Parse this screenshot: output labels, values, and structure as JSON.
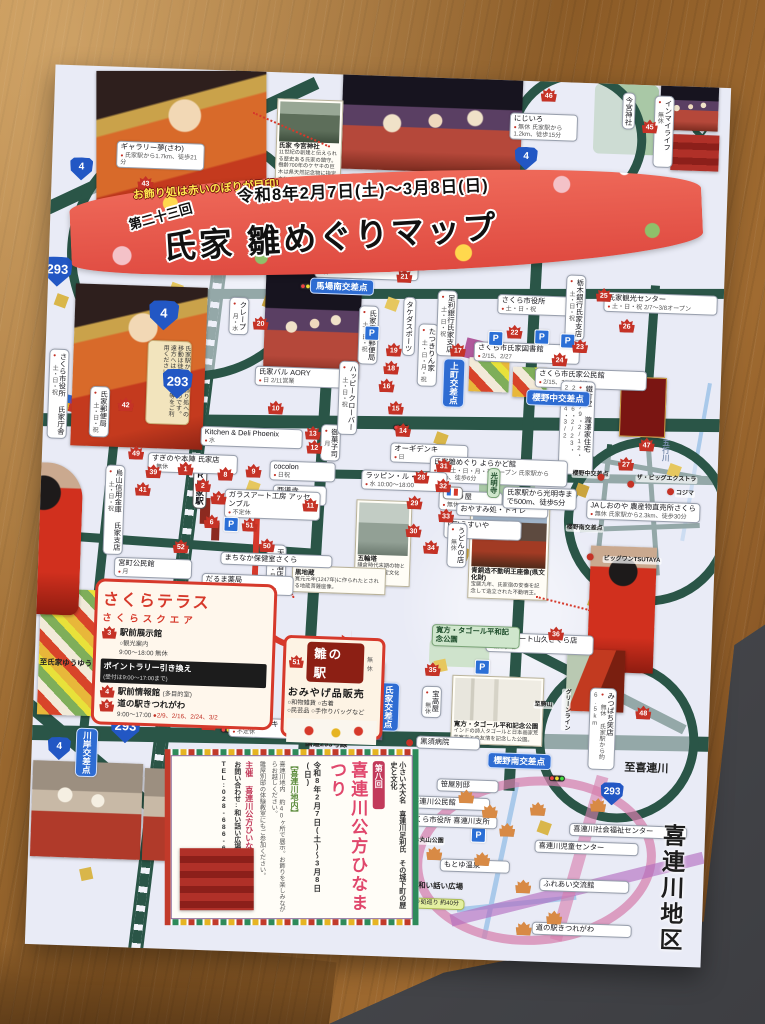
{
  "banner": {
    "tagline": "お飾り処は赤いのぼりが目印!",
    "edition": "第二十三回",
    "dates": "令和8年2月7日(土)〜3月8日(日)",
    "title": "氏家 雛めぐりマップ"
  },
  "sakura_terrace": {
    "heading": "さくらテラス",
    "sub": "さくらスクエア",
    "i1_num": "3",
    "i1_t": "駅前展示館",
    "i1_s1": "○観光案内",
    "i1_s2": "9:00〜18:00 無休",
    "rally": "ポイントラリー引き換え",
    "rally_s": "(受付は9:00〜17:00まで)",
    "i2_num": "4",
    "i3_num": "5",
    "i2_t": "駅前情報館",
    "i2_s": "(多目的室)",
    "i3_t": "道の駅きつれがわ",
    "hours": "9:00〜17:00",
    "days": "●2/9、2/16、2/24、3/2"
  },
  "hina_station": {
    "num": "51",
    "title": "雛の駅",
    "closed": "無休",
    "sub": "おみやげ品販売",
    "items1": "○和物雑貨 ○古着",
    "items2": "○民芸品 ○手作りバッグなど"
  },
  "kubo": {
    "edition": "第八回",
    "title": "喜連川公方ひなまつり",
    "dates": "令和8年2月7日(土)〜3月8日(日)",
    "area": "【喜連川地内】",
    "intro": "小さい大大名 喜連川足利氏 その城下町の歴史と文化",
    "body1": "喜連川地内 約40ヶ所で展示。お飾りを楽しみながらお越しください。",
    "body2": "雛屋別邸の体験教室にもご参加ください。",
    "org": "主催 喜連川公方ひいなの会",
    "contact": "お問い合わせ:和い話い広場",
    "tel": "TEL:028-686-6370"
  },
  "captions": {
    "imamiya_t": "氏家 今宮神社",
    "imamiya_b": "11世紀の創建と伝えられる歴史ある氏家の鎮守。樹齢700年のケヤキの巨木は県天然記念物に指定されている。",
    "fudo_t": "青銅造不動明王座像(県文化財)",
    "fudo_b": "宝暦九年、氏家宿の安泰を記念して造立された不動明王。",
    "gorin_t": "五輪塔",
    "gorin_b": "鎌倉時代末期の物とされる県指定文化財。",
    "kuro_t": "黒地蔵",
    "kuro_b": "寛元元年(1247年)に作られたとされる地蔵菩薩座像。",
    "tagore_t": "寛方・タゴール平和記念公園",
    "tagore_b": "インドの詩人タゴールと日本画家荒井寛方との友情を記念した公園。"
  },
  "misc": {
    "north": "N"
  },
  "overlays": [
    {
      "c": "shield sm",
      "st": "left:18px;top:92px",
      "t": "4"
    },
    {
      "c": "shield",
      "st": "left:-6px;top:192px",
      "t": "293"
    },
    {
      "c": "shield",
      "st": "left:102px;top:232px",
      "t": "4"
    },
    {
      "c": "shield",
      "st": "left:118px;top:300px",
      "t": "293"
    },
    {
      "c": "shield",
      "st": "left:78px;top:646px",
      "t": "293"
    },
    {
      "c": "shield sm",
      "st": "left:16px;top:672px",
      "t": "4"
    },
    {
      "c": "shield sm",
      "st": "left:462px;top:66px",
      "t": "4"
    },
    {
      "c": "shield sm",
      "st": "left:570px;top:698px",
      "t": "293"
    },
    {
      "c": "isec",
      "st": "left:262px;top:204px",
      "t": "馬場南交差点"
    },
    {
      "c": "isec v",
      "st": "left:398px;top:280px",
      "t": "上町交差点"
    },
    {
      "c": "isec",
      "st": "left:482px;top:308px",
      "t": "櫻野中交差点"
    },
    {
      "c": "isec",
      "st": "left:456px;top:672px",
      "t": "櫻野南交差点"
    },
    {
      "c": "isec v",
      "st": "left:44px;top:662px",
      "t": "川岸交差点"
    },
    {
      "c": "isec v",
      "st": "left:344px;top:606px",
      "t": "氏家交差点"
    },
    {
      "c": "co v jr",
      "st": "left:152px;top:386px",
      "t": "JR氏家駅"
    },
    {
      "c": "co",
      "st": "left:64px;top:74px;width:80px",
      "t": "ギャラリー夢(さわ)",
      "s2": "氏家駅から1.7km、徒歩21分"
    },
    {
      "c": "mk",
      "st": "left:86px;top:108px",
      "t": "43"
    },
    {
      "c": "mk",
      "st": "left:118px;top:124px",
      "t": "44"
    },
    {
      "c": "v",
      "st": "left:4px;top:284px",
      "t": "さくら市役所 氏家庁舎",
      "s2": "土・日・祝"
    },
    {
      "c": "v",
      "st": "left:46px;top:320px",
      "t": "氏家郵便局",
      "s2": "土・日・祝"
    },
    {
      "c": "mk",
      "st": "left:74px;top:330px",
      "t": "42"
    },
    {
      "c": "co",
      "st": "left:106px;top:384px;width:82px",
      "t": "すぎのや本陣 氏家店",
      "s2": "無休"
    },
    {
      "c": "v",
      "st": "left:64px;top:398px",
      "t": "烏山信用金庫 氏家支店",
      "s2": "土・日・祝"
    },
    {
      "c": "mk",
      "st": "left:94px;top:414px",
      "t": "41"
    },
    {
      "c": "mk",
      "st": "left:104px;top:396px",
      "t": "39"
    },
    {
      "c": "mk",
      "st": "left:86px;top:378px",
      "t": "49"
    },
    {
      "c": "mk",
      "st": "left:134px;top:470px",
      "t": "52"
    },
    {
      "c": "co",
      "st": "left:76px;top:490px;width:70px",
      "t": "宮町公民館",
      "s2": "月"
    },
    {
      "c": "note v",
      "st": "left:102px;top:272px;height:76px",
      "t": "氏家駅から各お飾り処への移動は徒歩がお勧めです。遠方へはタクシー等をご利用ください。"
    },
    {
      "c": "v",
      "st": "left:182px;top:226px",
      "t": "クレープ",
      "s2": "月・水"
    },
    {
      "c": "mk",
      "st": "left:206px;top:244px",
      "t": "20"
    },
    {
      "c": "co",
      "st": "left:210px;top:294px;width:84px",
      "t": "氏家バル AORY",
      "s2": "日 2/11営業"
    },
    {
      "c": "mk",
      "st": "left:224px;top:328px",
      "t": "10"
    },
    {
      "c": "mk",
      "st": "left:262px;top:352px",
      "t": "13"
    },
    {
      "c": "co",
      "st": "left:158px;top:356px;width:94px",
      "t": "Kitchen & Deli Phoenix",
      "s2": "水"
    },
    {
      "c": "co",
      "st": "left:228px;top:388px;width:58px",
      "t": "cocolon",
      "s2": "日祝"
    },
    {
      "c": "v",
      "st": "left:278px;top:350px",
      "t": "御菓子司",
      "s2": "月"
    },
    {
      "c": "mk",
      "st": "left:264px;top:366px",
      "t": "12"
    },
    {
      "c": "co",
      "st": "left:232px;top:412px;width:46px",
      "t": "西導寺",
      "s2": "無休"
    },
    {
      "c": "mk",
      "st": "left:262px;top:424px",
      "t": "11"
    },
    {
      "c": "co",
      "st": "left:184px;top:418px;width:88px",
      "t": "ガラスアート工房 アッセンブル",
      "s2": "不定休"
    },
    {
      "c": "mk",
      "st": "left:136px;top:392px",
      "t": "1"
    },
    {
      "c": "mk",
      "st": "left:154px;top:408px",
      "t": "2"
    },
    {
      "c": "mk",
      "st": "left:170px;top:420px",
      "t": "7"
    },
    {
      "c": "mk",
      "st": "left:164px;top:444px",
      "t": "6"
    },
    {
      "c": "mk",
      "st": "left:176px;top:396px",
      "t": "8"
    },
    {
      "c": "mk",
      "st": "left:204px;top:392px",
      "t": "9"
    },
    {
      "c": "mk",
      "st": "left:202px;top:446px",
      "t": "51"
    },
    {
      "c": "mk",
      "st": "left:220px;top:466px",
      "t": "50"
    },
    {
      "c": "v",
      "st": "left:228px;top:472px",
      "t": "天王酒店",
      "s2": "日・月祝"
    },
    {
      "c": "co",
      "st": "left:182px;top:481px;width:104px",
      "t": "まちなか保健室さくら"
    },
    {
      "c": "co",
      "st": "left:164px;top:503px;width:84px",
      "t": "だるま薬局",
      "s2": "火・木・土のみオープン"
    },
    {
      "c": "co",
      "st": "left:266px;top:184px;width:96px",
      "t": "ナチュラルダイニング",
      "s2": "日"
    },
    {
      "c": "mk",
      "st": "left:348px;top:192px",
      "t": "21"
    },
    {
      "c": "v",
      "st": "left:312px;top:230px",
      "t": "氏家馬場郵便局",
      "s2": "土・日・祝"
    },
    {
      "c": "mk",
      "st": "left:340px;top:266px",
      "t": "19"
    },
    {
      "c": "mk",
      "st": "left:338px;top:284px",
      "t": "18"
    },
    {
      "c": "v",
      "st": "left:356px;top:220px",
      "t": "タケダスポーツ"
    },
    {
      "c": "v",
      "st": "left:372px;top:246px",
      "t": "たつきりん家",
      "s2": "土・日・月・祝"
    },
    {
      "c": "mk",
      "st": "left:404px;top:264px",
      "t": "17"
    },
    {
      "c": "v",
      "st": "left:390px;top:212px",
      "t": "足利銀行氏家支店",
      "s2": "土・日・祝"
    },
    {
      "c": "v",
      "st": "left:294px;top:286px",
      "t": "ハッピークローバー",
      "s2": "土・日・祝"
    },
    {
      "c": "mk",
      "st": "left:334px;top:302px",
      "t": "16"
    },
    {
      "c": "mk",
      "st": "left:344px;top:324px",
      "t": "15"
    },
    {
      "c": "mk",
      "st": "left:352px;top:346px",
      "t": "14"
    },
    {
      "c": "co",
      "st": "left:348px;top:366px;width:70px",
      "t": "オーギデンキ",
      "s2": "日"
    },
    {
      "c": "co",
      "st": "left:450px;top:214px;width:72px",
      "t": "さくら市役所",
      "s2": "土・日・祝"
    },
    {
      "c": "mk",
      "st": "left:460px;top:244px",
      "t": "22"
    },
    {
      "c": "v",
      "st": "left:518px;top:192px",
      "t": "栃木銀行氏家支店",
      "s2": "土・日・祝"
    },
    {
      "c": "mk",
      "st": "left:548px;top:204px",
      "t": "25"
    },
    {
      "c": "co",
      "st": "left:556px;top:208px;width:106px",
      "t": "氏家観光センター",
      "s2": "土・日・祝 2/7〜3/8オープン"
    },
    {
      "c": "mk",
      "st": "left:572px;top:234px",
      "t": "26"
    },
    {
      "c": "co",
      "st": "left:428px;top:262px;width:98px",
      "t": "さくら市氏家図書館",
      "s2": "2/15、2/27"
    },
    {
      "c": "mk",
      "st": "left:506px;top:270px",
      "t": "24"
    },
    {
      "c": "co",
      "st": "left:490px;top:286px;width:104px",
      "t": "さくら市氏家公民館",
      "s2": "2/15、2/16、3/2"
    },
    {
      "c": "mk",
      "st": "left:526px;top:256px",
      "t": "23"
    },
    {
      "c": "v",
      "st": "left:516px;top:298px;height:86px",
      "t": "鐵竹堂 瀧澤家住宅",
      "s2": "2/9・2/12・2/16・2/23・2/24・3/2"
    },
    {
      "c": "mk",
      "st": "left:576px;top:372px",
      "t": "27"
    },
    {
      "c": "pk",
      "st": "left:318px;top:250px",
      "t": "P"
    },
    {
      "c": "pk",
      "st": "left:442px;top:251px",
      "t": "P"
    },
    {
      "c": "pk",
      "st": "left:488px;top:248px",
      "t": "P"
    },
    {
      "c": "pk",
      "st": "left:514px;top:251px",
      "t": "P"
    },
    {
      "c": "pk",
      "st": "left:184px;top:446px",
      "t": "P"
    },
    {
      "c": "pk",
      "st": "left:440px;top:580px",
      "t": "P"
    },
    {
      "c": "pk",
      "st": "left:442px;top:748px",
      "t": "P"
    },
    {
      "c": "tl",
      "st": "left:252px;top:210px"
    },
    {
      "c": "tl",
      "st": "left:350px;top:348px"
    },
    {
      "c": "tl",
      "st": "left:188px;top:656px"
    },
    {
      "c": "tl",
      "st": "left:362px;top:676px"
    },
    {
      "c": "tl",
      "st": "left:518px;top:693px"
    },
    {
      "c": "co",
      "st": "left:388px;top:378px;width:130px",
      "t": "氏家雛めぐり よらかど館",
      "s2": "金・土・日・月・祝オープン 氏家駅から450m、徒歩6分"
    },
    {
      "c": "mk",
      "st": "left:372px;top:392px",
      "t": "28"
    },
    {
      "c": "co",
      "st": "left:398px;top:412px;width:56px",
      "t": "めぐり屋",
      "s2": "無休"
    },
    {
      "c": "mk",
      "st": "left:366px;top:418px",
      "t": "29"
    },
    {
      "c": "co",
      "st": "left:404px;top:440px;width:70px",
      "t": "(有)うすいや",
      "s2": "無休"
    },
    {
      "c": "mk",
      "st": "left:366px;top:446px",
      "t": "30"
    },
    {
      "c": "co",
      "st": "left:320px;top:394px;width:78px",
      "t": "ラッピン・ル・モ",
      "s2": "水 10:00〜18:00"
    },
    {
      "c": "mk",
      "st": "left:394px;top:380px",
      "t": "31"
    },
    {
      "c": "mk",
      "st": "left:394px;top:400px",
      "t": "32"
    },
    {
      "c": "co",
      "st": "left:416px;top:424px;width:84px",
      "t": "おやすみ処・トイレ"
    },
    {
      "c": "mk",
      "st": "left:398px;top:430px",
      "t": "33"
    },
    {
      "c": "wc",
      "st": "left:402px;top:408px"
    },
    {
      "c": "v green",
      "st": "left:446px;top:388px",
      "t": "光明寺"
    },
    {
      "c": "co",
      "st": "left:462px;top:406px;width:66px",
      "t": "氏家駅から光明寺まで500m、徒歩5分"
    },
    {
      "c": "v",
      "st": "left:408px;top:444px",
      "t": "うどんの店",
      "s2": "無休"
    },
    {
      "c": "mk",
      "st": "left:384px;top:462px",
      "t": "34"
    },
    {
      "c": "co",
      "st": "left:92px;top:630px;width:92px",
      "t": "神山塗装工業(株)",
      "s2": "日・水"
    },
    {
      "c": "mk",
      "st": "left:166px;top:626px",
      "t": "37"
    },
    {
      "c": "co",
      "st": "left:196px;top:646px;width:84px",
      "t": "工房 オオタキ",
      "s2": "不定休"
    },
    {
      "c": "mk",
      "st": "left:168px;top:646px",
      "t": "38"
    },
    {
      "c": "co",
      "st": "left:450px;top:552px;width:100px",
      "t": "ビッグミート山久さくら店",
      "s2": "第3水曜"
    },
    {
      "c": "mk",
      "st": "left:512px;top:544px",
      "t": "36"
    },
    {
      "c": "mk",
      "st": "left:390px;top:584px",
      "t": "35"
    },
    {
      "c": "v",
      "st": "left:388px;top:608px",
      "t": "宝高屋",
      "s2": "無休"
    },
    {
      "c": "green",
      "st": "left:396px;top:546px;width:80px",
      "t": "寛方・タゴール平和記念公園"
    },
    {
      "c": "dot",
      "st": "left:374px;top:662px"
    },
    {
      "c": "co",
      "st": "left:384px;top:658px;width:56px",
      "t": "黒須病院"
    },
    {
      "c": "plain",
      "st": "left:270px;top:664px",
      "t": "国道293号線"
    },
    {
      "c": "plain",
      "st": "left:2px;top:592px",
      "t": "至氏家ゆうゆうパーク"
    },
    {
      "c": "plain big",
      "st": "left:590px;top:676px",
      "t": "至喜連川"
    },
    {
      "c": "plain v faint",
      "st": "left:618px;top:350px",
      "t": "五行川"
    },
    {
      "c": "v",
      "st": "left:568px;top:8px",
      "t": "今宮神社"
    },
    {
      "c": "mk",
      "st": "left:588px;top:34px",
      "t": "45"
    },
    {
      "c": "v",
      "st": "left:600px;top:10px;height:64px",
      "t": "インマイライフ",
      "s2": "無休"
    },
    {
      "c": "mk",
      "st": "left:486px;top:6px",
      "t": "46"
    },
    {
      "c": "co",
      "st": "left:456px;top:32px;width:60px",
      "t": "にじいろ",
      "s2": "無休 氏家駅から1.2km、徒歩15分"
    },
    {
      "c": "mk",
      "st": "left:596px;top:352px",
      "t": "47"
    },
    {
      "c": "co",
      "st": "left:546px;top:416px;width:106px",
      "t": "JAしおのや 農産物直売所さくら",
      "s2": "無休 氏家駅から2.3km、徒歩30分"
    },
    {
      "c": "plain t6",
      "st": "left:530px;top:388px",
      "t": "櫻野中交差点"
    },
    {
      "c": "plain t6",
      "st": "left:594px;top:390px",
      "t": "ザ・ビッグエクストラ"
    },
    {
      "c": "plain t6",
      "st": "left:634px;top:404px",
      "t": "コジマ"
    },
    {
      "c": "plain t6",
      "st": "left:526px;top:442px",
      "t": "櫻野南交差点"
    },
    {
      "c": "plain t6",
      "st": "left:564px;top:472px",
      "t": "ビッグワンTSUTAYA"
    },
    {
      "c": "dot",
      "st": "left:586px;top:396px"
    },
    {
      "c": "dot",
      "st": "left:626px;top:402px"
    },
    {
      "c": "dot",
      "st": "left:556px;top:390px"
    },
    {
      "c": "dot",
      "st": "left:548px;top:470px"
    },
    {
      "c": "mk",
      "st": "left:602px;top:620px",
      "t": "48"
    },
    {
      "c": "v",
      "st": "left:556px;top:604px;height:74px",
      "t": "みつばち笑店",
      "s2": "無休 氏家駅から約6.5km"
    },
    {
      "c": "plain t6",
      "st": "left:500px;top:620px",
      "t": "至勝山"
    },
    {
      "c": "plain t6 v",
      "st": "left:528px;top:606px",
      "t": "グリーンライン"
    },
    {
      "c": "co",
      "st": "left:406px;top:700px;width:54px",
      "t": "笹屋別邸"
    },
    {
      "c": "co",
      "st": "left:378px;top:718px;width:74px",
      "t": "喜連川公民館"
    },
    {
      "c": "co",
      "st": "left:374px;top:736px;width:86px",
      "t": "さくら市役所 喜連川支所"
    },
    {
      "c": "plain t6",
      "st": "left:384px;top:760px",
      "t": "お丸山公園"
    },
    {
      "c": "co",
      "st": "left:412px;top:780px;width:62px",
      "t": "もとゆ温泉"
    },
    {
      "c": "plain",
      "st": "left:388px;top:802px",
      "t": "和い話い広場"
    },
    {
      "c": "co",
      "st": "left:540px;top:740px;width:110px",
      "t": "喜連川社会福祉センター"
    },
    {
      "c": "co",
      "st": "left:506px;top:758px;width:96px",
      "t": "喜連川児童センター"
    },
    {
      "c": "co",
      "st": "left:512px;top:796px;width:82px",
      "t": "ふれあい交流館"
    },
    {
      "c": "co",
      "st": "left:506px;top:840px;width:92px",
      "t": "道の駅きつれがわ"
    },
    {
      "c": "ylw",
      "st": "left:372px;top:820px;width:58px",
      "t": "お飾り処巡り 約40分"
    },
    {
      "c": "plain v huge",
      "st": "left:628px;top:734px",
      "t": "喜連川地区"
    },
    {
      "c": "mk or",
      "st": "left:428px;top:710px"
    },
    {
      "c": "mk or",
      "st": "left:452px;top:724px"
    },
    {
      "c": "mk or",
      "st": "left:470px;top:742px"
    },
    {
      "c": "mk or",
      "st": "left:560px;top:714px"
    },
    {
      "c": "mk or",
      "st": "left:500px;top:720px"
    },
    {
      "c": "mk or",
      "st": "left:446px;top:772px"
    },
    {
      "c": "mk or",
      "st": "left:488px;top:798px"
    },
    {
      "c": "mk or",
      "st": "left:520px;top:828px"
    },
    {
      "c": "mk or",
      "st": "left:398px;top:768px"
    },
    {
      "c": "mk or",
      "st": "left:490px;top:840px"
    }
  ]
}
